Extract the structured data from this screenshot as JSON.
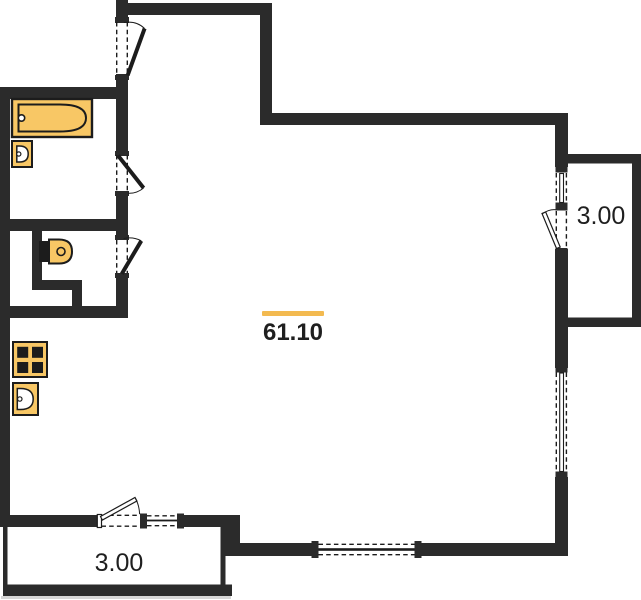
{
  "canvas": {
    "width": 641,
    "height": 600,
    "background": "#ffffff"
  },
  "colors": {
    "wall": "#2b2b2b",
    "line": "#1c1c1c",
    "fixture": "#f8c765",
    "accent": "#f3ba50",
    "shadow": "#d6d6d6"
  },
  "labels": {
    "main_area": "61.10",
    "right_balcony_area": "3.00",
    "bottom_balcony_area": "3.00"
  },
  "fixtures": [
    {
      "name": "bathtub"
    },
    {
      "name": "washbasin-bathroom"
    },
    {
      "name": "washbasin-wc"
    },
    {
      "name": "cooktop-4-burner"
    },
    {
      "name": "kitchen-sink"
    }
  ],
  "openings": {
    "doors": [
      "entry-door",
      "bathroom-door",
      "wc-door",
      "bottom-balcony-door",
      "right-balcony-door"
    ],
    "windows": [
      "window-right-top",
      "window-right-main",
      "window-bottom-left",
      "window-bottom-center"
    ]
  }
}
